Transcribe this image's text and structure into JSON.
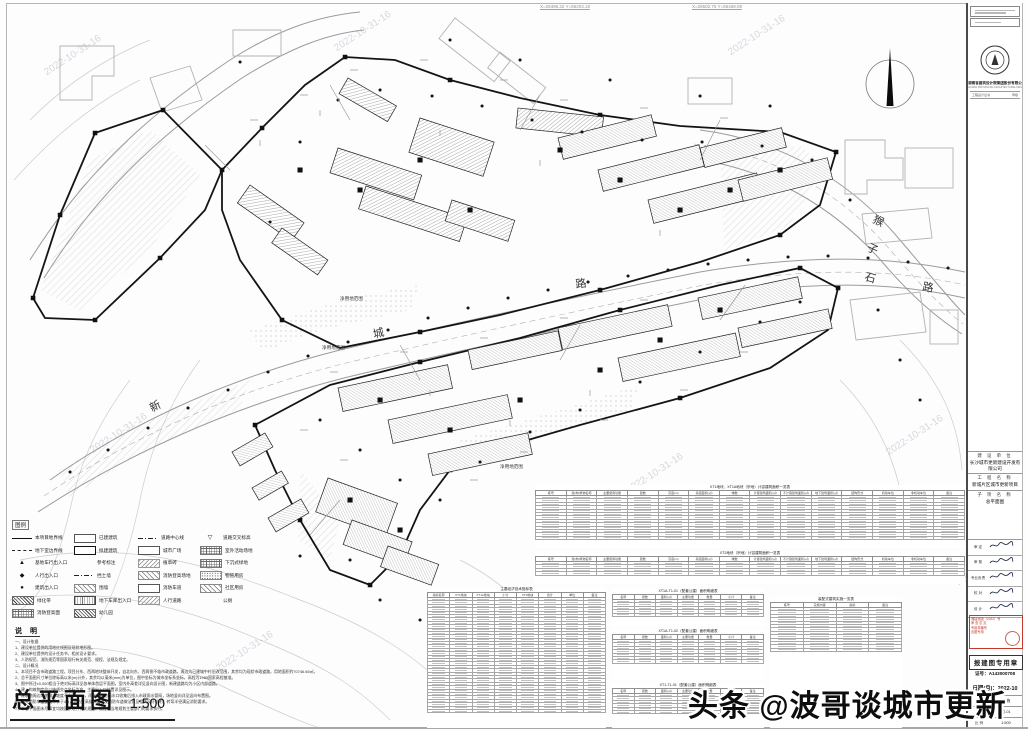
{
  "watermark": {
    "text": "头条 @波哥谈城市更新"
  },
  "faint_watermark": {
    "text": "2022-10-31-16"
  },
  "drawing": {
    "title": "总平面图",
    "scale": "1:500",
    "coord1": "X=28496.32  Y=55203.18",
    "coord2": "X=28502.75  Y=55468.09",
    "road1": [
      "新",
      "城",
      "路"
    ],
    "road2": [
      "猴",
      "子",
      "石",
      "路"
    ],
    "site_label1": "净用地范围",
    "site_label2": "净用地范围",
    "site_label3": "净用地范围"
  },
  "legend": {
    "title": "图例",
    "col1": [
      {
        "s": "line-solid",
        "t": "本项目地界线"
      },
      {
        "s": "line-dash",
        "t": "地下室边界线"
      },
      {
        "s": "blank",
        "g": "▲",
        "t": "基地车行出入口"
      },
      {
        "s": "blank",
        "g": "◆",
        "t": "人行出入口"
      },
      {
        "s": "blank",
        "g": "●",
        "t": "建筑出入口"
      },
      {
        "s": "hatch-dense",
        "t": "绿化带"
      },
      {
        "s": "hatch-grid",
        "t": "消防登高面"
      }
    ],
    "col2": [
      {
        "s": "rect-empty",
        "t": "已建建筑"
      },
      {
        "s": "rect-bold",
        "t": "拟建建筑"
      },
      {
        "s": "blank",
        "t": "参考标注"
      },
      {
        "s": "line-dashdot",
        "t": "挡土墙"
      },
      {
        "s": "hatch-lite",
        "t": "围墙"
      },
      {
        "s": "ramp",
        "t": "地下车库出入口"
      },
      {
        "s": "hatch-dense",
        "t": "幼儿园"
      }
    ],
    "col3": [
      {
        "s": "line-dashdot",
        "t": "道路中心线"
      },
      {
        "s": "rect-empty",
        "t": "城市广场"
      },
      {
        "s": "texture",
        "t": "植草砖"
      },
      {
        "s": "hatch-lite",
        "t": "消防登高场地"
      },
      {
        "s": "rect-empty",
        "t": "消防车道"
      },
      {
        "s": "texture",
        "t": "人行道路"
      }
    ],
    "col4": [
      {
        "s": "blank",
        "g": "▽",
        "t": "道路交叉标高"
      },
      {
        "s": "hatch-grid",
        "t": "室外活动场地"
      },
      {
        "s": "hatch-grid",
        "t": "下沉式绿地"
      },
      {
        "s": "dots",
        "t": "物管用房"
      },
      {
        "s": "hatch-lite",
        "t": "社区用房"
      },
      {
        "s": "blank",
        "t": "公厕"
      }
    ]
  },
  "notes": {
    "title": "说 明",
    "lines": [
      "一、设计依据",
      "1、建设单位提供的用地红线图及现状地形图。",
      "2、建设单位提供的设计任务书、相关设计要求。",
      "3、人防规范、消防规范等国家现行有关规范、规程、法规及规定。",
      "二、设计概况",
      "1、本项目不含市政道路工程，项目分东、西两地块整体开发，自北向东、西两侧不临市政道路，周边为已建城中村旧改范围，其余均为现状市政道路，用地面积约70746.66㎡。",
      "2、总平面图尺寸单位除标高以米(m)计外，其余均以毫米(mm)为单位，图中坐标为城市坐标系坐标，高程为1985国家高程基准。",
      "3、图中所注±0.000相当于绝对标高详见各单体首层平面图，室内外高差详见竖向设计图，新建道路均为小区内部道路。",
      "4、建、构筑物定位以轴线交点坐标为准，主要出入口位置详见图示。",
      "5、建筑物周边场地排水坡度不小于0.5%，雨水经场地雨水口收集后排入市政雨水管网，场地竖向详见竖向布置图。",
      "6、室外消防车道宽度不小于4m，消防登高操作场地及消防车道做法详见相关设计说明，转弯半径满足消防要求。",
      "7、本总平面图未尽事宜均按国家现行有关规范、规程及当地规划主管部门的要求执行。"
    ]
  },
  "tables": {
    "bigA": {
      "title": "XT1地块、XT1A地块（宗地）计容建筑面积一览表",
      "headers": [
        "栋号",
        "建(构)筑物名称",
        "主要使用功能",
        "层数",
        "高度(m)",
        "基底面积(㎡)",
        "幢数",
        "计容建筑面积(㎡)",
        "不计容建筑面积(㎡)",
        "地下建筑面积(㎡)",
        "结构形式",
        "机动车位",
        "非机动车位",
        "备注"
      ],
      "rows": 13
    },
    "bigB": {
      "title": "XT2地块（宗地）计容建筑面积一览表",
      "headers": [
        "栋号",
        "建(构)筑物名称",
        "主要使用功能",
        "层数",
        "高度(m)",
        "基底面积(㎡)",
        "幢数",
        "计容建筑面积(㎡)",
        "不计容建筑面积(㎡)",
        "地下建筑面积(㎡)",
        "结构形式",
        "机动车位",
        "非机动车位",
        "备注"
      ],
      "rows": 4
    },
    "tallC": {
      "title": "主要经济技术指标表",
      "headers": [
        "指标名称",
        "XT1地块",
        "XT1A地块",
        "小计",
        "XT2地块",
        "合计",
        "单位",
        "备注"
      ],
      "rows": 34
    },
    "d1": {
      "title": "XT1A-T1-01（配套公建）面积明细表",
      "headers": [
        "名称",
        "层数",
        "面积(㎡)",
        "主要功能",
        "数量",
        "小计",
        "备注"
      ],
      "rows": 5
    },
    "d2": {
      "title": "XT1A-T1-02（配套公建）面积明细表",
      "headers": [
        "名称",
        "层数",
        "面积(㎡)",
        "主要功能",
        "数量",
        "小计",
        "备注"
      ],
      "rows": 7
    },
    "d3": {
      "title": "XT1-T1-01（配套公建）面积明细表",
      "headers": [
        "名称",
        "层数",
        "面积(㎡)",
        "主要功能",
        "数量",
        "小计",
        "备注"
      ],
      "rows": 6
    },
    "e": {
      "title": "装配式建筑实施一览表",
      "headers": [
        "栋号",
        "实施内容",
        "指标",
        "备注"
      ],
      "rows": 13
    }
  },
  "titleblock": {
    "company": "湖南省建筑设计院集团股份有限公司",
    "company_en": "HUNAN PROVINCIAL ARCHITECTURAL DESIGN INSTITUTE",
    "cert_l": "工程设计证书",
    "cert_r": "甲级",
    "rows": [
      {
        "label": "建 设 单 位",
        "value": "长沙城市更新建设开发有限公司"
      },
      {
        "label": "工 程 名 称",
        "value": "新城片区城市更新项目"
      },
      {
        "label": "子 项 名 称",
        "value": "总平面图"
      }
    ],
    "signatures": [
      {
        "role": "审 定"
      },
      {
        "role": "审 核"
      },
      {
        "role": "专业负责"
      },
      {
        "role": "校 对"
      },
      {
        "role": "设 计"
      }
    ],
    "red_lines": [
      "湘建设函〔2022〕号",
      "审 查 意 见",
      "专用章编号",
      "出图专用"
    ],
    "stamp": "报建图专用章",
    "cert_no": "证号：A143000708",
    "date": "日期(月)：2022-10",
    "mini_rows": [
      {
        "label": "图 别",
        "value": "建 施"
      },
      {
        "label": "图 号",
        "value": "总-01"
      },
      {
        "label": "比 例",
        "value": "1:500"
      }
    ]
  }
}
